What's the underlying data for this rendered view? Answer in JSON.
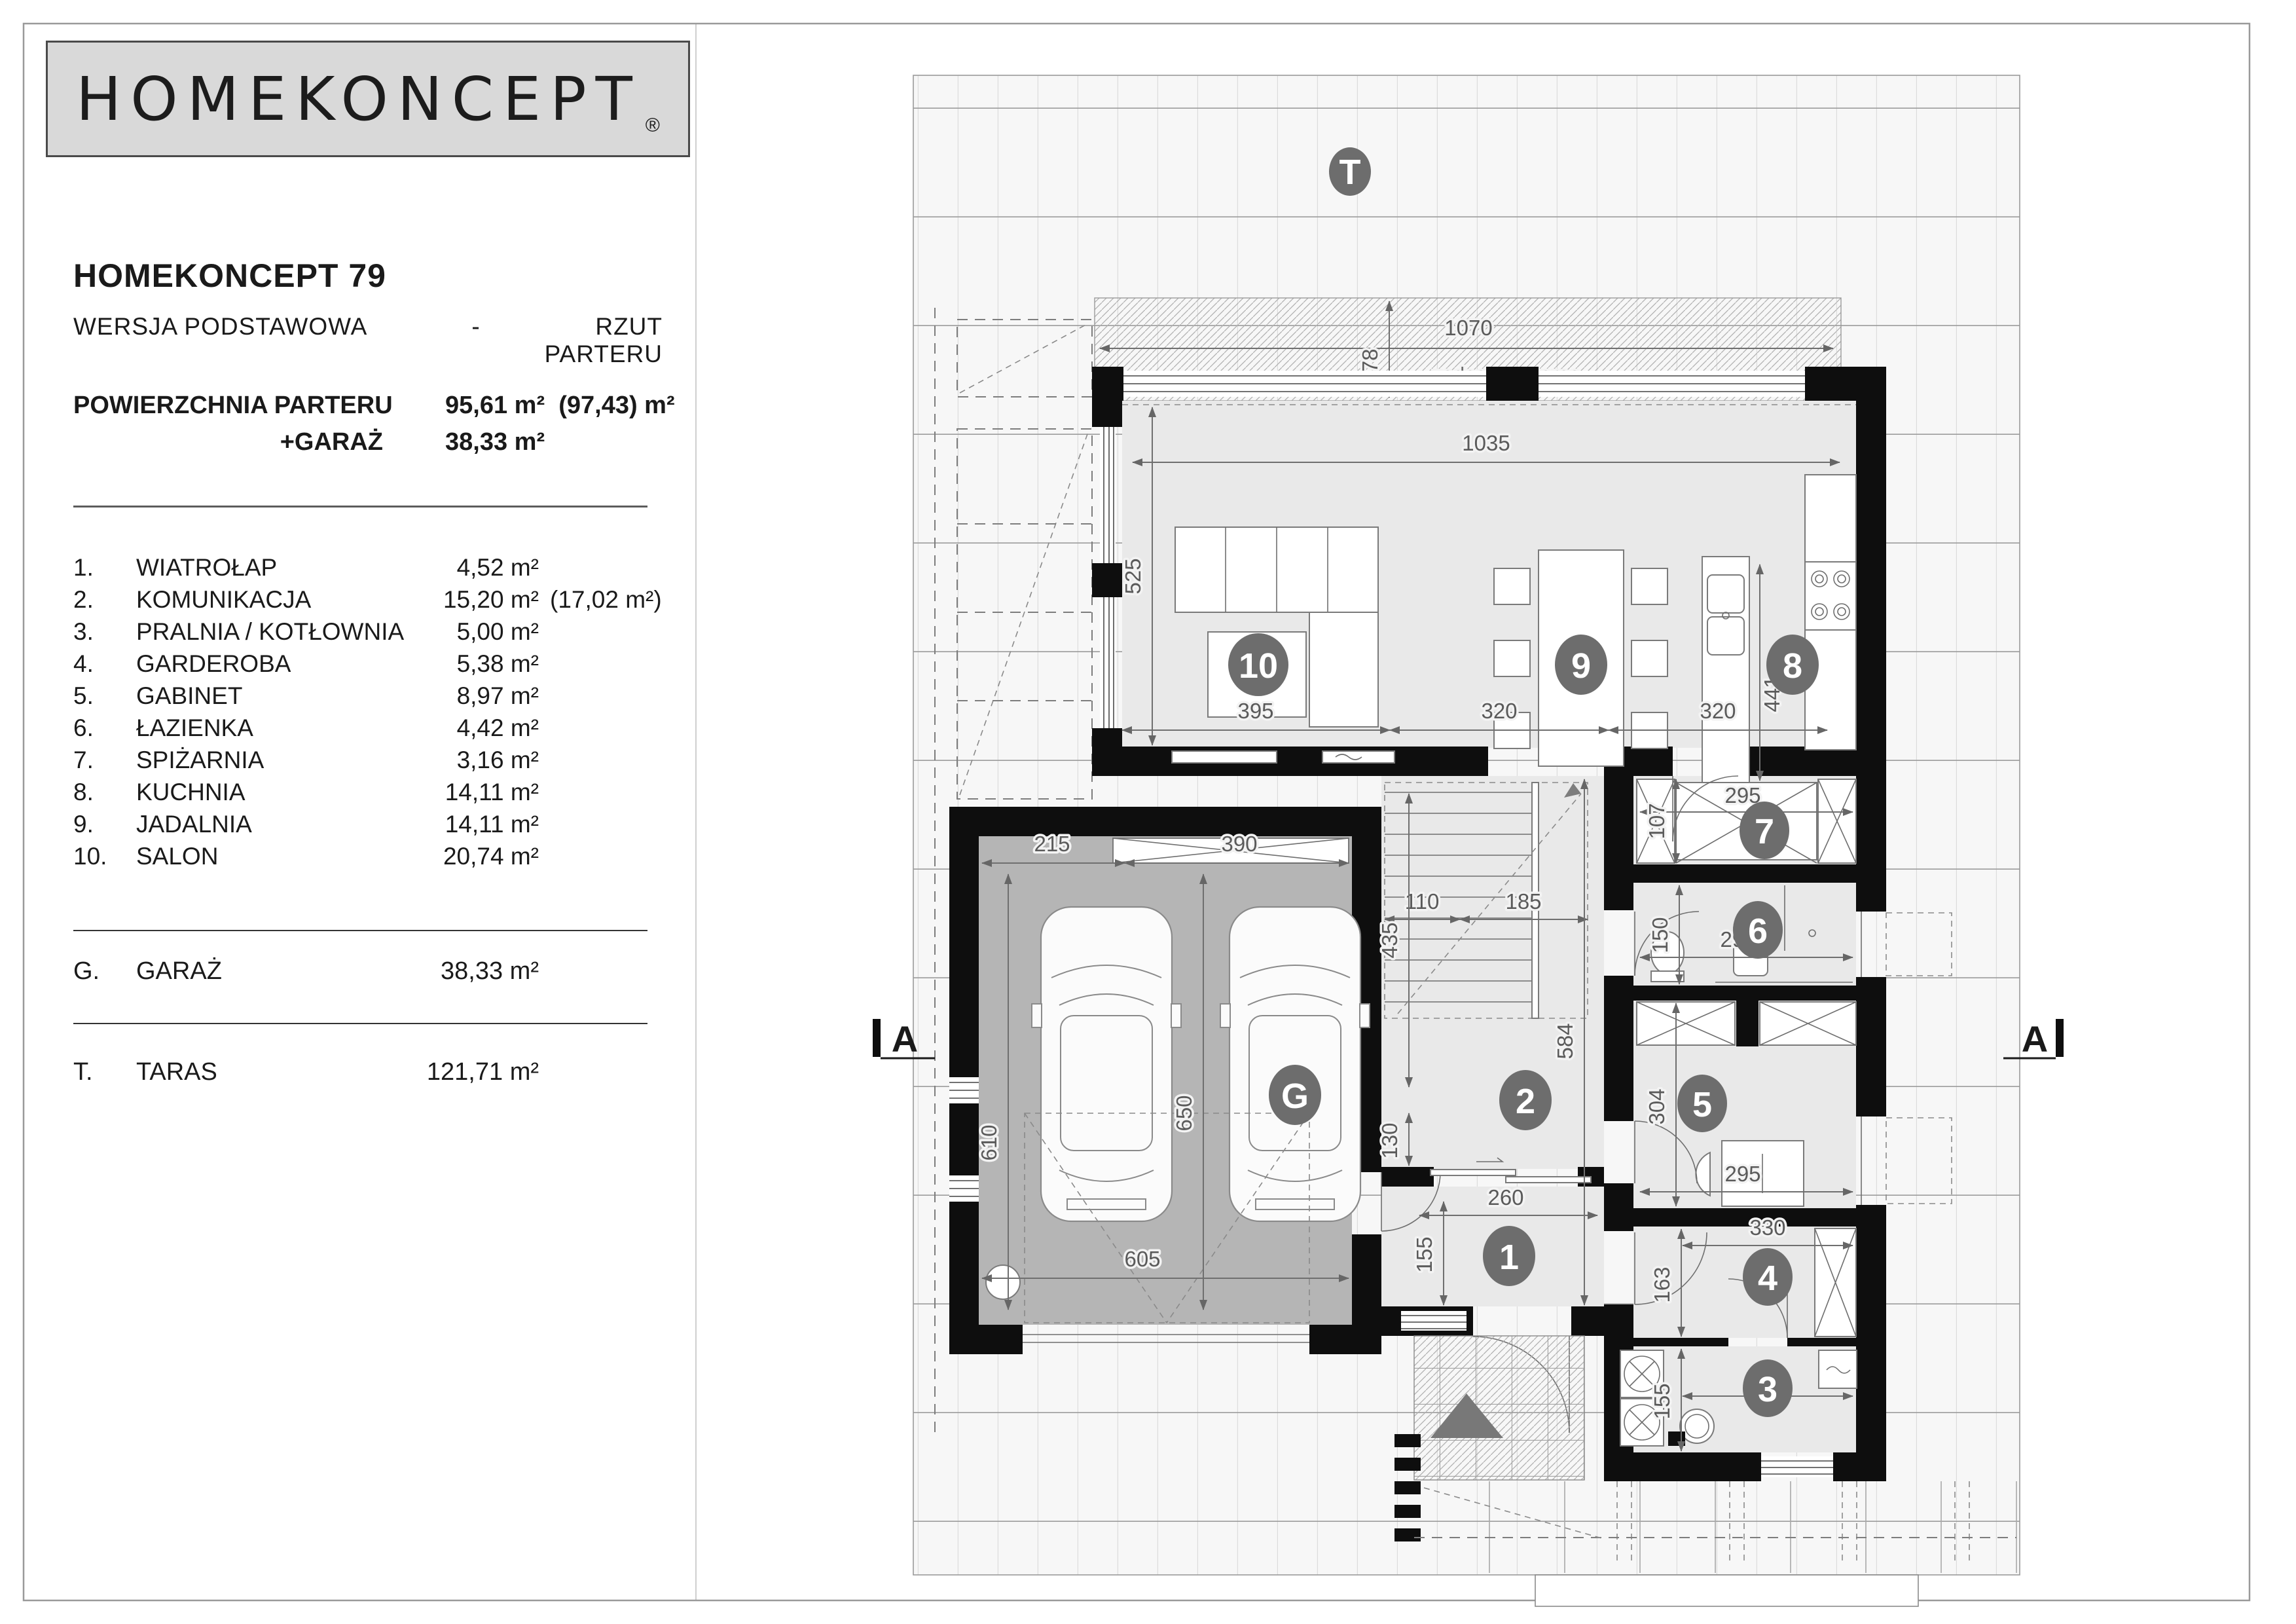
{
  "page": {
    "brand": "HOMEKONCEPT",
    "brand_reg": "®",
    "title": "HOMEKONCEPT 79",
    "subtitle_left": "WERSJA  PODSTAWOWA",
    "subtitle_dash": "-",
    "subtitle_right": "RZUT PARTERU"
  },
  "areas": {
    "label1": "POWIERZCHNIA PARTERU",
    "value1": "95,61 m²",
    "value1_alt": "(97,43) m²",
    "label2": "+GARAŻ",
    "value2": "38,33 m²"
  },
  "rooms": [
    {
      "num": "1.",
      "label": "WIATROŁAP",
      "area": "4,52 m²",
      "alt": ""
    },
    {
      "num": "2.",
      "label": "KOMUNIKACJA",
      "area": "15,20 m²",
      "alt": "(17,02 m²)"
    },
    {
      "num": "3.",
      "label": "PRALNIA / KOTŁOWNIA",
      "area": "5,00 m²",
      "alt": ""
    },
    {
      "num": "4.",
      "label": "GARDEROBA",
      "area": "5,38 m²",
      "alt": ""
    },
    {
      "num": "5.",
      "label": "GABINET",
      "area": "8,97 m²",
      "alt": ""
    },
    {
      "num": "6.",
      "label": "ŁAZIENKA",
      "area": "4,42 m²",
      "alt": ""
    },
    {
      "num": "7.",
      "label": "SPIŻARNIA",
      "area": "3,16 m²",
      "alt": ""
    },
    {
      "num": "8.",
      "label": "KUCHNIA",
      "area": "14,11 m²",
      "alt": ""
    },
    {
      "num": "9.",
      "label": "JADALNIA",
      "area": "14,11 m²",
      "alt": ""
    },
    {
      "num": "10.",
      "label": "SALON",
      "area": "20,74 m²",
      "alt": ""
    }
  ],
  "garage_row": {
    "num": "G.",
    "label": "GARAŻ",
    "area": "38,33 m²"
  },
  "terrace_row": {
    "num": "T.",
    "label": "TARAS",
    "area": "121,71 m²"
  },
  "plan": {
    "labels": {
      "covered_terrace": "zadaszony taras"
    },
    "numbers": {
      "n1": "1",
      "n2": "2",
      "n3": "3",
      "n4": "4",
      "n5": "5",
      "n6": "6",
      "n7": "7",
      "n8": "8",
      "n9": "9",
      "n10": "10",
      "g": "G",
      "t": "T",
      "a": "A"
    },
    "dims": {
      "t1070": "1070",
      "t178": "178",
      "t1035": "1035",
      "t525": "525",
      "b395": "395",
      "b320a": "320",
      "b320b": "320",
      "k441": "441",
      "r7w": "295",
      "r7h": "107",
      "r6w": "295",
      "r6h": "150",
      "r5w": "295",
      "r5h": "304",
      "r4w": "330",
      "r4h": "163",
      "r3w": "330",
      "r3h": "155",
      "r1w": "260",
      "r1h": "155",
      "s110": "110",
      "s185": "185",
      "s435": "435",
      "s584": "584",
      "s130": "130",
      "g215": "215",
      "g390": "390",
      "g610": "610",
      "g650": "650",
      "g605": "605"
    }
  }
}
